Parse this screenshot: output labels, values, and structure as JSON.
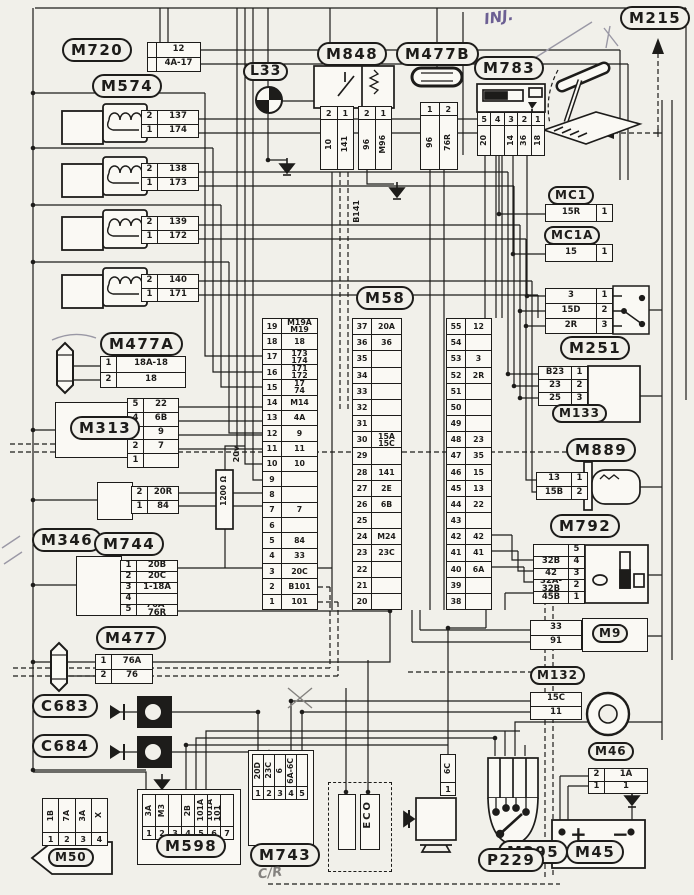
{
  "annotations": {
    "inj": "INJ.",
    "cr": "C/R",
    "b141": "B141",
    "res": "1200 Ω",
    "volt": "20v",
    "eco": "ECO",
    "bat_plus": "+",
    "bat_minus": "−"
  },
  "colors": {
    "paper": "#f1f0ea",
    "ink": "#1d1c1a",
    "pencil": "#6c5f93"
  },
  "tags": {
    "m720": "M720",
    "m574": "M574",
    "l33": "L33",
    "m848": "M848",
    "m477b": "M477B",
    "m783": "M783",
    "m215": "M215",
    "mc1": "MC1",
    "mc1a": "MC1A",
    "m251": "M251",
    "m58": "M58",
    "m477a": "M477A",
    "m313": "M313",
    "m133": "M133",
    "m889": "M889",
    "m346": "M346",
    "m792": "M792",
    "m744": "M744",
    "m9": "M9",
    "m477": "M477",
    "m132": "M132",
    "c683": "C683",
    "c684": "C684",
    "m46": "M46",
    "m50": "M50",
    "m598": "M598",
    "m743": "M743",
    "m295": "M295",
    "p229": "P229",
    "m45": "M45"
  },
  "tables": {
    "m720_box": [
      [
        "",
        "12"
      ],
      [
        "",
        "4A-17"
      ]
    ],
    "inj1": [
      [
        "2",
        "137"
      ],
      [
        "1",
        "174"
      ]
    ],
    "inj2": [
      [
        "2",
        "138"
      ],
      [
        "1",
        "173"
      ]
    ],
    "inj3": [
      [
        "2",
        "139"
      ],
      [
        "1",
        "172"
      ]
    ],
    "inj4": [
      [
        "2",
        "140"
      ],
      [
        "1",
        "171"
      ]
    ],
    "mc1": [
      [
        "15R",
        "1"
      ]
    ],
    "mc1a": [
      [
        "15",
        "1"
      ]
    ],
    "m251": [
      [
        "3",
        "1"
      ],
      [
        "15D",
        "2"
      ],
      [
        "2R",
        "3"
      ]
    ],
    "m477a": [
      [
        "1",
        "18A-18"
      ],
      [
        "2",
        "18"
      ]
    ],
    "m313": [
      [
        "5",
        "22"
      ],
      [
        "4",
        "6B"
      ],
      [
        "3",
        "9"
      ],
      [
        "2",
        "7"
      ],
      [
        "1",
        ""
      ]
    ],
    "m133": [
      [
        "B23",
        "1"
      ],
      [
        "23",
        "2"
      ],
      [
        "25",
        "3"
      ]
    ],
    "m889": [
      [
        "13",
        "1"
      ],
      [
        "15B",
        "2"
      ]
    ],
    "m346": [
      [
        "2",
        "20R"
      ],
      [
        "1",
        "84"
      ]
    ],
    "m792": [
      [
        "",
        "5"
      ],
      [
        "32B",
        "4"
      ],
      [
        "42",
        "3"
      ],
      [
        "32A-32B",
        "2"
      ],
      [
        "45B",
        "1"
      ]
    ],
    "m744": [
      [
        "1",
        "20B"
      ],
      [
        "2",
        "20C"
      ],
      [
        "3",
        "1-18A"
      ],
      [
        "4",
        ""
      ],
      [
        "5",
        "76A-76R"
      ]
    ],
    "m9": [
      [
        "33"
      ],
      [
        "91"
      ]
    ],
    "m477": [
      [
        "1",
        "76A"
      ],
      [
        "2",
        "76"
      ]
    ],
    "m132": [
      [
        "15C"
      ],
      [
        "11"
      ]
    ],
    "m46": [
      [
        "2",
        "1A"
      ],
      [
        "1",
        "1"
      ]
    ]
  },
  "vtables": {
    "m848_a": [
      [
        "2",
        "10"
      ],
      [
        "1",
        "141"
      ]
    ],
    "m848_b": [
      [
        "2",
        "96"
      ],
      [
        "1",
        "M96"
      ]
    ],
    "m477b": [
      [
        "1",
        "96"
      ],
      [
        "2",
        "76R"
      ]
    ],
    "m783": [
      [
        "5",
        "20"
      ],
      [
        "4",
        ""
      ],
      [
        "3",
        "14"
      ],
      [
        "2",
        "36"
      ],
      [
        "1",
        "18"
      ]
    ],
    "m295": [
      [
        "1",
        "6C"
      ]
    ],
    "m598": [
      [
        "1",
        "3A"
      ],
      [
        "2",
        "M3"
      ],
      [
        "3",
        ""
      ],
      [
        "4",
        "2B"
      ],
      [
        "5",
        "101A"
      ],
      [
        "6",
        "101A\n101"
      ],
      [
        "7",
        ""
      ]
    ],
    "m743": [
      [
        "1",
        "20D"
      ],
      [
        "2",
        "23C"
      ],
      [
        "3",
        "6"
      ],
      [
        "4",
        "6A-6C"
      ],
      [
        "5",
        ""
      ]
    ],
    "m50": [
      [
        "1",
        "1B"
      ],
      [
        "2",
        "7A"
      ],
      [
        "3",
        "3A"
      ],
      [
        "4",
        "X"
      ]
    ]
  },
  "columns": {
    "c1": [
      [
        "19",
        "M19A\nM19"
      ],
      [
        "18",
        "18"
      ],
      [
        "17",
        "173\n174"
      ],
      [
        "16",
        "171\n172"
      ],
      [
        "15",
        "17\n74"
      ],
      [
        "14",
        "M14"
      ],
      [
        "13",
        "4A"
      ],
      [
        "12",
        "9"
      ],
      [
        "11",
        "11"
      ],
      [
        "10",
        "10"
      ],
      [
        "9",
        ""
      ],
      [
        "8",
        ""
      ],
      [
        "7",
        "7"
      ],
      [
        "6",
        ""
      ],
      [
        "5",
        "84"
      ],
      [
        "4",
        "33"
      ],
      [
        "3",
        "20C"
      ],
      [
        "2",
        "B101"
      ],
      [
        "1",
        "101"
      ]
    ],
    "c2": [
      [
        "37",
        "20A"
      ],
      [
        "36",
        "36"
      ],
      [
        "35",
        ""
      ],
      [
        "34",
        ""
      ],
      [
        "33",
        ""
      ],
      [
        "32",
        ""
      ],
      [
        "31",
        ""
      ],
      [
        "30",
        "15A\n15C"
      ],
      [
        "29",
        ""
      ],
      [
        "28",
        "141"
      ],
      [
        "27",
        "2E"
      ],
      [
        "26",
        "6B"
      ],
      [
        "25",
        ""
      ],
      [
        "24",
        "M24"
      ],
      [
        "23",
        "23C"
      ],
      [
        "22",
        ""
      ],
      [
        "21",
        ""
      ],
      [
        "20",
        ""
      ]
    ],
    "c3": [
      [
        "55",
        "12"
      ],
      [
        "54",
        ""
      ],
      [
        "53",
        "3"
      ],
      [
        "52",
        "2R"
      ],
      [
        "51",
        ""
      ],
      [
        "50",
        ""
      ],
      [
        "49",
        ""
      ],
      [
        "48",
        "23"
      ],
      [
        "47",
        "35"
      ],
      [
        "46",
        "15"
      ],
      [
        "45",
        "13"
      ],
      [
        "44",
        "22"
      ],
      [
        "43",
        ""
      ],
      [
        "42",
        "42"
      ],
      [
        "41",
        "41"
      ],
      [
        "40",
        "6A"
      ],
      [
        "39",
        ""
      ],
      [
        "38",
        ""
      ]
    ]
  }
}
